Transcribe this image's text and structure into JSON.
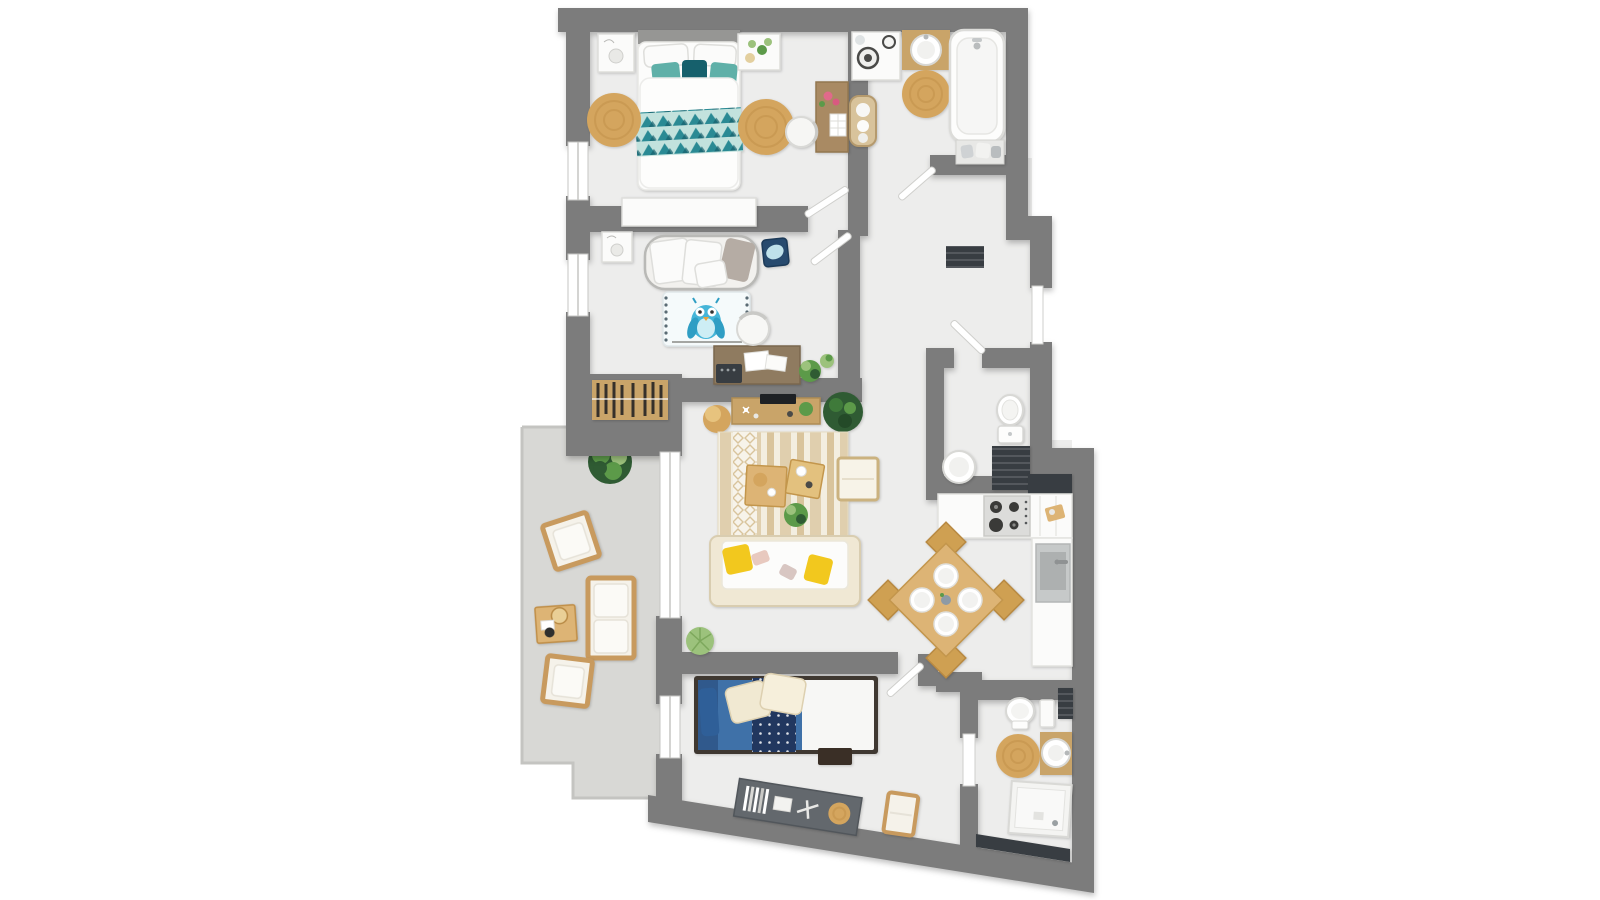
{
  "scene": {
    "type": "floor-plan",
    "view": "top-down-3d-render",
    "background": "#ffffff",
    "labels_visible": "none"
  },
  "colors": {
    "bg": "#ffffff",
    "wall": "#7c7c7c",
    "floor": "#ededec",
    "terrace": "#d8d8d5",
    "railing": "#c4c4c1",
    "white": "#fbfbfa",
    "outline": "#dededb",
    "wood": "#c9a469",
    "wood_light": "#ddb475",
    "wood_desk": "#8f7b60",
    "jute": "#d4a55e",
    "jute_ring": "#c08f47",
    "teal": "#2a8a94",
    "teal_dark": "#16606c",
    "teal_light": "#5fb0a8",
    "band": "#c2e2dd",
    "yellow": "#f2c81e",
    "blue_duvet": "#3f71a8",
    "navy": "#21375f",
    "owl": "#45b5d8",
    "plant": "#5c9a49",
    "plant_dark": "#2f5b33",
    "plant_light": "#9cc27c",
    "dark": "#383d42",
    "steel": "#c2c5c6",
    "cream": "#f0e8d4",
    "cream_stroke": "#d9cdb0",
    "gray_pillow": "#b5aca4"
  },
  "rooms": [
    {
      "id": "bedroom-1",
      "area": "top-left",
      "furniture": [
        "double-bed-teal-duvet",
        "white-pillows",
        "teal-cushions",
        "nightstand-left",
        "nightstand-right",
        "jute-rug-left",
        "jute-rug-right",
        "low-dresser",
        "desk-with-flowers",
        "desk-chair"
      ]
    },
    {
      "id": "bathroom-1",
      "area": "top-right",
      "furniture": [
        "washing-machine",
        "laundry-basket",
        "wood-vanity-round-sink",
        "jute-rug",
        "bathtub",
        "towel-shelf"
      ]
    },
    {
      "id": "hallway",
      "area": "center",
      "furniture": [
        "dark-doormat"
      ]
    },
    {
      "id": "nursery",
      "area": "middle-left",
      "furniture": [
        "daybed-with-pillows",
        "nightstand",
        "blue-tray-table",
        "owl-rug",
        "desk",
        "chair",
        "typewriter",
        "plants",
        "open-wardrobe"
      ]
    },
    {
      "id": "living-room",
      "area": "center",
      "furniture": [
        "sideboard-with-tv",
        "jute-pouf",
        "striped-rug",
        "coffee-table-1",
        "coffee-table-2",
        "bench",
        "sofa-yellow-cushions",
        "potted-plants"
      ]
    },
    {
      "id": "wc",
      "area": "center-right",
      "furniture": [
        "toilet",
        "round-basin-table",
        "dark-cabinet"
      ]
    },
    {
      "id": "kitchen",
      "area": "right",
      "furniture": [
        "counter-with-stove",
        "dark-backsplash",
        "sink-counter",
        "square-dining-table",
        "four-chairs",
        "four-plates",
        "cutting-board"
      ]
    },
    {
      "id": "bedroom-2",
      "area": "bottom",
      "furniture": [
        "single-bed-blue",
        "dotted-runner",
        "cream-pillows",
        "foot-bench",
        "angled-console",
        "books",
        "toy-plane",
        "small-jute-mat",
        "side-chair"
      ]
    },
    {
      "id": "bathroom-2",
      "area": "bottom-right",
      "furniture": [
        "toilet",
        "white-cabinet",
        "dark-shelf",
        "jute-rug",
        "wood-vanity-round-sink",
        "shower",
        "dark-slatted-bench"
      ]
    },
    {
      "id": "terrace",
      "area": "left-outdoor",
      "furniture": [
        "bush",
        "armchair-top",
        "outdoor-sofa",
        "coffee-table-with-tray",
        "armchair-bottom"
      ]
    }
  ],
  "openings": {
    "windows": [
      "bedroom-1-left",
      "nursery-left",
      "living-room-slider",
      "bedroom-2-left"
    ],
    "swing_doors": [
      "bathroom-1",
      "bedroom-1",
      "nursery",
      "wc",
      "bedroom-2"
    ],
    "door-panels": [
      "entry-front-door",
      "bathroom-2-door"
    ]
  }
}
